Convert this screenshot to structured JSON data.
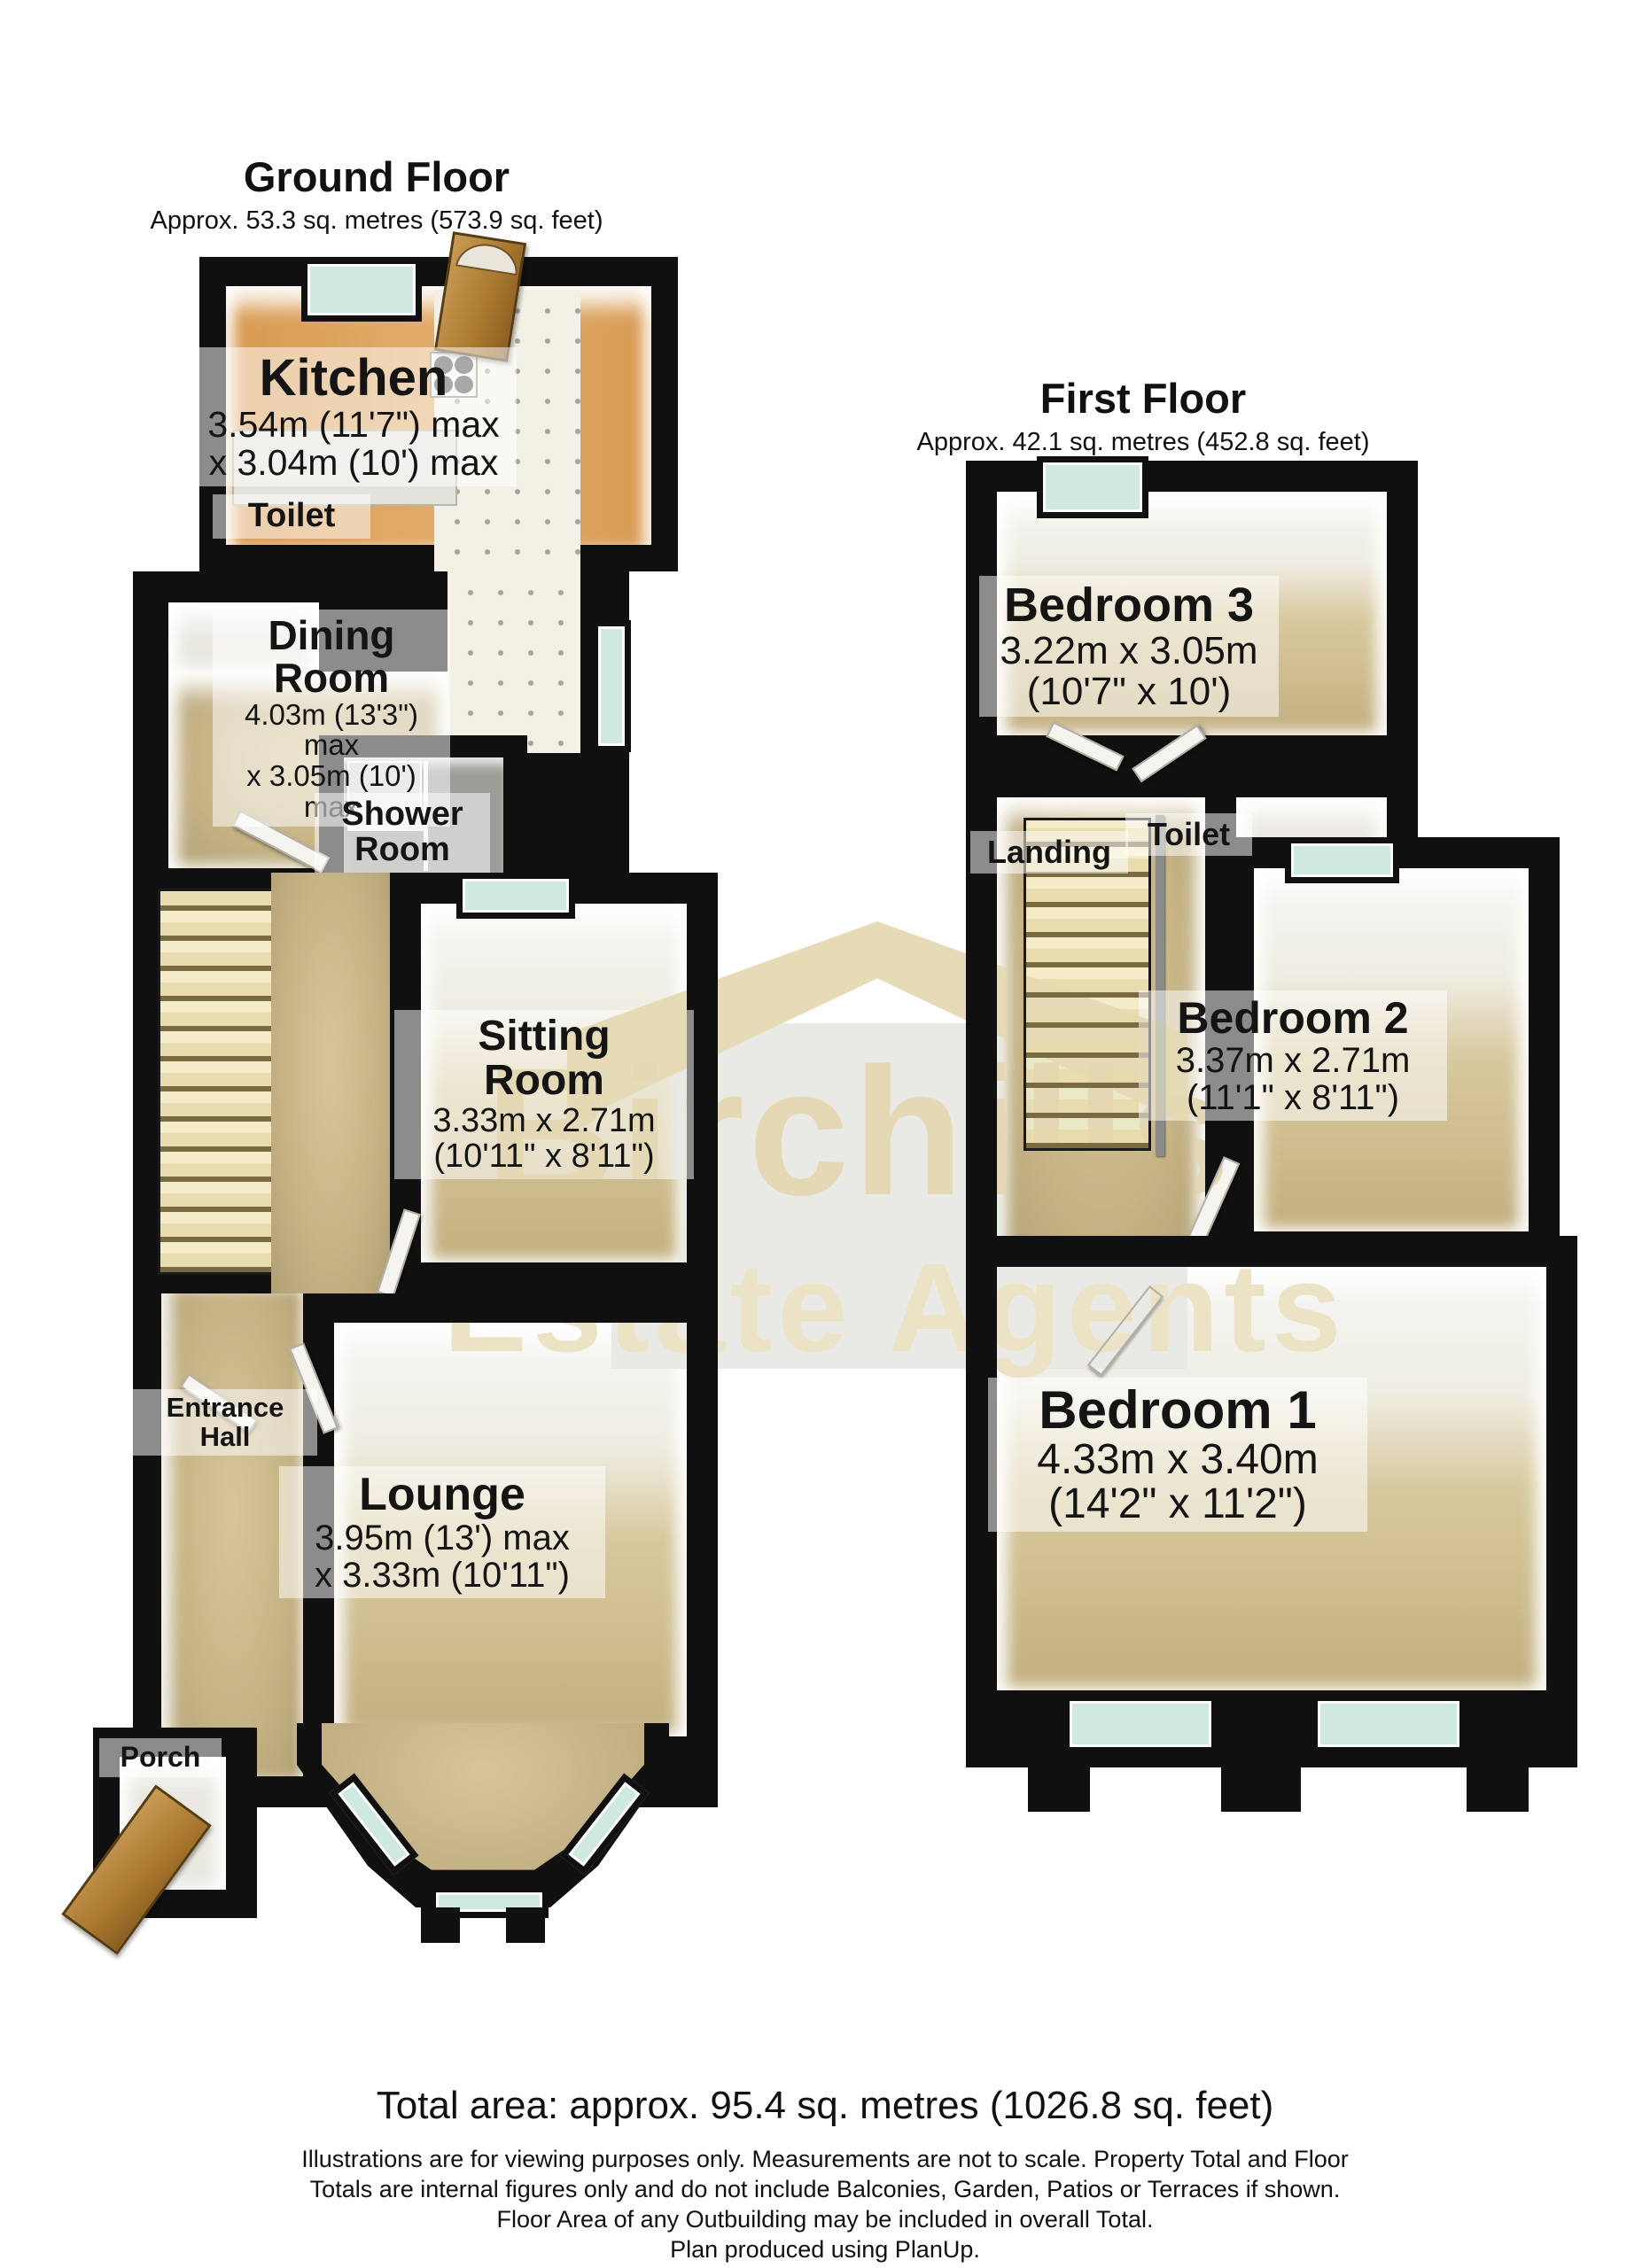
{
  "ground_floor": {
    "title": "Ground Floor",
    "subtitle": "Approx. 53.3 sq. metres (573.9 sq. feet)",
    "rooms": {
      "kitchen": {
        "name": "Kitchen",
        "dim1": "3.54m (11'7\") max",
        "dim2": "x 3.04m (10') max"
      },
      "toilet": {
        "name": "Toilet"
      },
      "dining": {
        "name_line1": "Dining",
        "name_line2": "Room",
        "dim1": "4.03m (13'3\") max",
        "dim2": "x 3.05m (10') max"
      },
      "shower": {
        "name_line1": "Shower",
        "name_line2": "Room"
      },
      "sitting": {
        "name_line1": "Sitting",
        "name_line2": "Room",
        "dim1": "3.33m x 2.71m",
        "dim2": "(10'11\" x 8'11\")"
      },
      "entrance": {
        "name_line1": "Entrance",
        "name_line2": "Hall"
      },
      "lounge": {
        "name": "Lounge",
        "dim1": "3.95m (13') max",
        "dim2": "x 3.33m (10'11\")"
      },
      "porch": {
        "name": "Porch"
      }
    }
  },
  "first_floor": {
    "title": "First Floor",
    "subtitle": "Approx. 42.1 sq. metres (452.8 sq. feet)",
    "rooms": {
      "bedroom3": {
        "name": "Bedroom 3",
        "dim1": "3.22m x 3.05m",
        "dim2": "(10'7\" x 10')"
      },
      "landing": {
        "name": "Landing"
      },
      "toilet": {
        "name": "Toilet"
      },
      "bedroom2": {
        "name": "Bedroom 2",
        "dim1": "3.37m x 2.71m",
        "dim2": "(11'1\" x 8'11\")"
      },
      "bedroom1": {
        "name": "Bedroom 1",
        "dim1": "4.33m x 3.40m",
        "dim2": "(14'2\" x 11'2\")"
      }
    }
  },
  "watermark": {
    "line1": "Birchills",
    "line2": "Estate Agents"
  },
  "footer": {
    "total_area": "Total area: approx. 95.4 sq. metres (1026.8 sq. feet)",
    "disclaimer_line1": "Illustrations are for viewing purposes only. Measurements are not to scale. Property Total and Floor",
    "disclaimer_line2": "Totals are internal figures only and do not include Balconies, Garden, Patios or Terraces if shown.",
    "disclaimer_line3": "Floor Area of any Outbuilding may be included in overall Total.",
    "disclaimer_line4": "Plan produced using PlanUp.",
    "colors": {
      "wall": "#101010",
      "floor": "#c7b588",
      "window": "#cfe8e2",
      "kitchen_floor": "#dda45f",
      "watermark": "#e7dab6"
    }
  }
}
